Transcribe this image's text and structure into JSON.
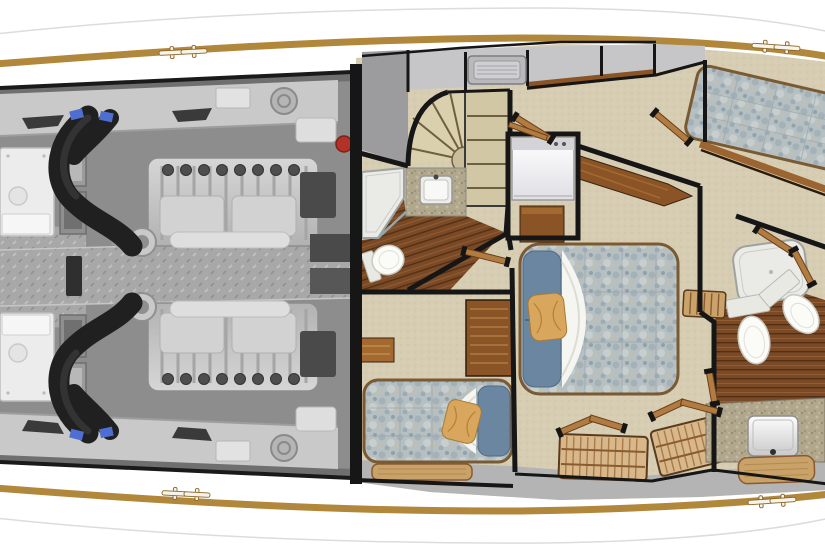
{
  "colors": {
    "caprail": "#b0873b",
    "hull_faint_line": "#dcdcdc",
    "wall": "#161616",
    "carpet": "#d6cdb3",
    "deck_gray": "#b4b4b4",
    "cabinet_gray": "#c6c6c8",
    "foyer_gray": "#9c9c9f",
    "teak": "#7a4a26",
    "teak_line": "#53301563",
    "wood": "#8a5426",
    "wood_light": "#b07c42",
    "cane": "#d8b88a",
    "duvet": "#b6c0c3",
    "pillow_blue": "#6b86a1",
    "pillow_gold": "#d8a65c",
    "sheet_white": "#f5f5f1",
    "granite": "#b1a78d",
    "shower_pan": "#eaebe6",
    "porcelain": "#fbfbf8",
    "stair_tread": "#dbd0ad",
    "engine_floor": "#8d8d8d",
    "engine_shelf": "#c9c9c9",
    "engine_body_light": "#d6d6d6",
    "engine_body_dark": "#b2b2b2",
    "walkway_plate": "#a8a8a8",
    "exhaust_hose": "#202020",
    "hose_clamp_blue": "#4e6ed2",
    "extinguisher_red": "#b23227"
  },
  "scene": {
    "type": "yacht-lower-deck-floor-plan",
    "orientation": "bow-right-stern-left",
    "hull": {
      "cleat_count": 4,
      "caprail_material": "teak"
    },
    "sections": {
      "engine_room": {
        "objects": [
          "port-engine",
          "starboard-engine",
          "port-exhaust-hose",
          "starboard-exhaust-hose",
          "port-generator",
          "starboard-generator",
          "center-walkway",
          "equipment-shelves",
          "fire-extinguisher",
          "deck-step"
        ]
      },
      "foyer": {
        "objects": [
          "curved-staircase",
          "straight-steps",
          "overhead-hatch",
          "storage-cabinets"
        ]
      },
      "day_head": {
        "objects": [
          "shower-stall",
          "vanity-sink",
          "toilet",
          "teak-sole"
        ]
      },
      "laundry": {
        "objects": [
          "washer-dryer"
        ]
      },
      "master_stateroom": {
        "objects": [
          "double-berth",
          "blue-pillows",
          "gold-accent-pillow",
          "turned-sheet",
          "nightstand",
          "forward-dresser",
          "cane-closet-aft",
          "cane-closet-fwd",
          "bifold-closet-doors"
        ]
      },
      "guest_stateroom": {
        "objects": [
          "single-berth",
          "blue-pillow",
          "gold-accent-pillow",
          "drawer-dresser",
          "wall-shelf",
          "bench"
        ]
      },
      "forward_stateroom": {
        "objects": [
          "single-berth",
          "white-pillow",
          "entry-door"
        ]
      },
      "forward_head": {
        "objects": [
          "shower-stall",
          "toilet-aft",
          "toilet-fwd",
          "granite-vanity",
          "vanity-sink",
          "bench",
          "slatted-locker",
          "teak-sole"
        ]
      },
      "corridor": {
        "objects": [
          "door-leaves",
          "wood-thresholds"
        ]
      }
    }
  }
}
